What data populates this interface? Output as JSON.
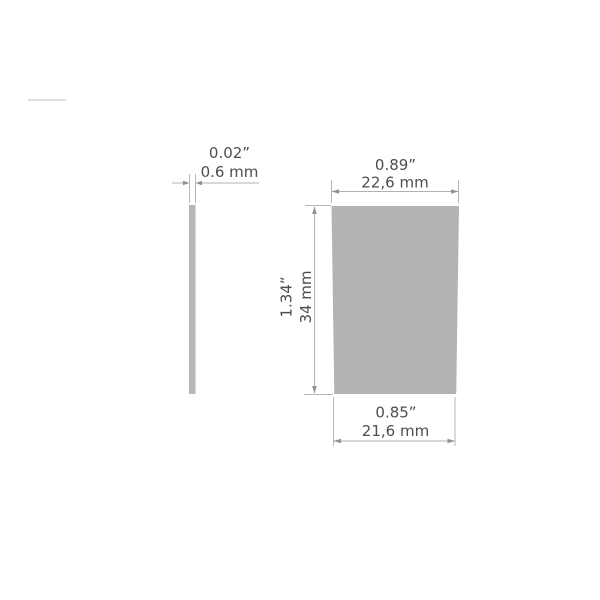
{
  "drawing": {
    "side_view": {
      "thickness_in": "0.02”",
      "thickness_mm": "0.6 mm"
    },
    "front_view": {
      "top_width_in": "0.89”",
      "top_width_mm": "22,6 mm",
      "height_in": "1.34”",
      "height_mm": "34 mm",
      "bottom_width_in": "0.85”",
      "bottom_width_mm": "21,6 mm"
    },
    "colors": {
      "front_plate_fill": "#b3b3b3",
      "side_plate_fill": "#b6b6b6",
      "dimension_line": "#b0b0b0",
      "arrow": "#8f9092",
      "label_text": "#4c4d4f",
      "watermark_line": "#dedede",
      "background": "#ffffff"
    }
  }
}
